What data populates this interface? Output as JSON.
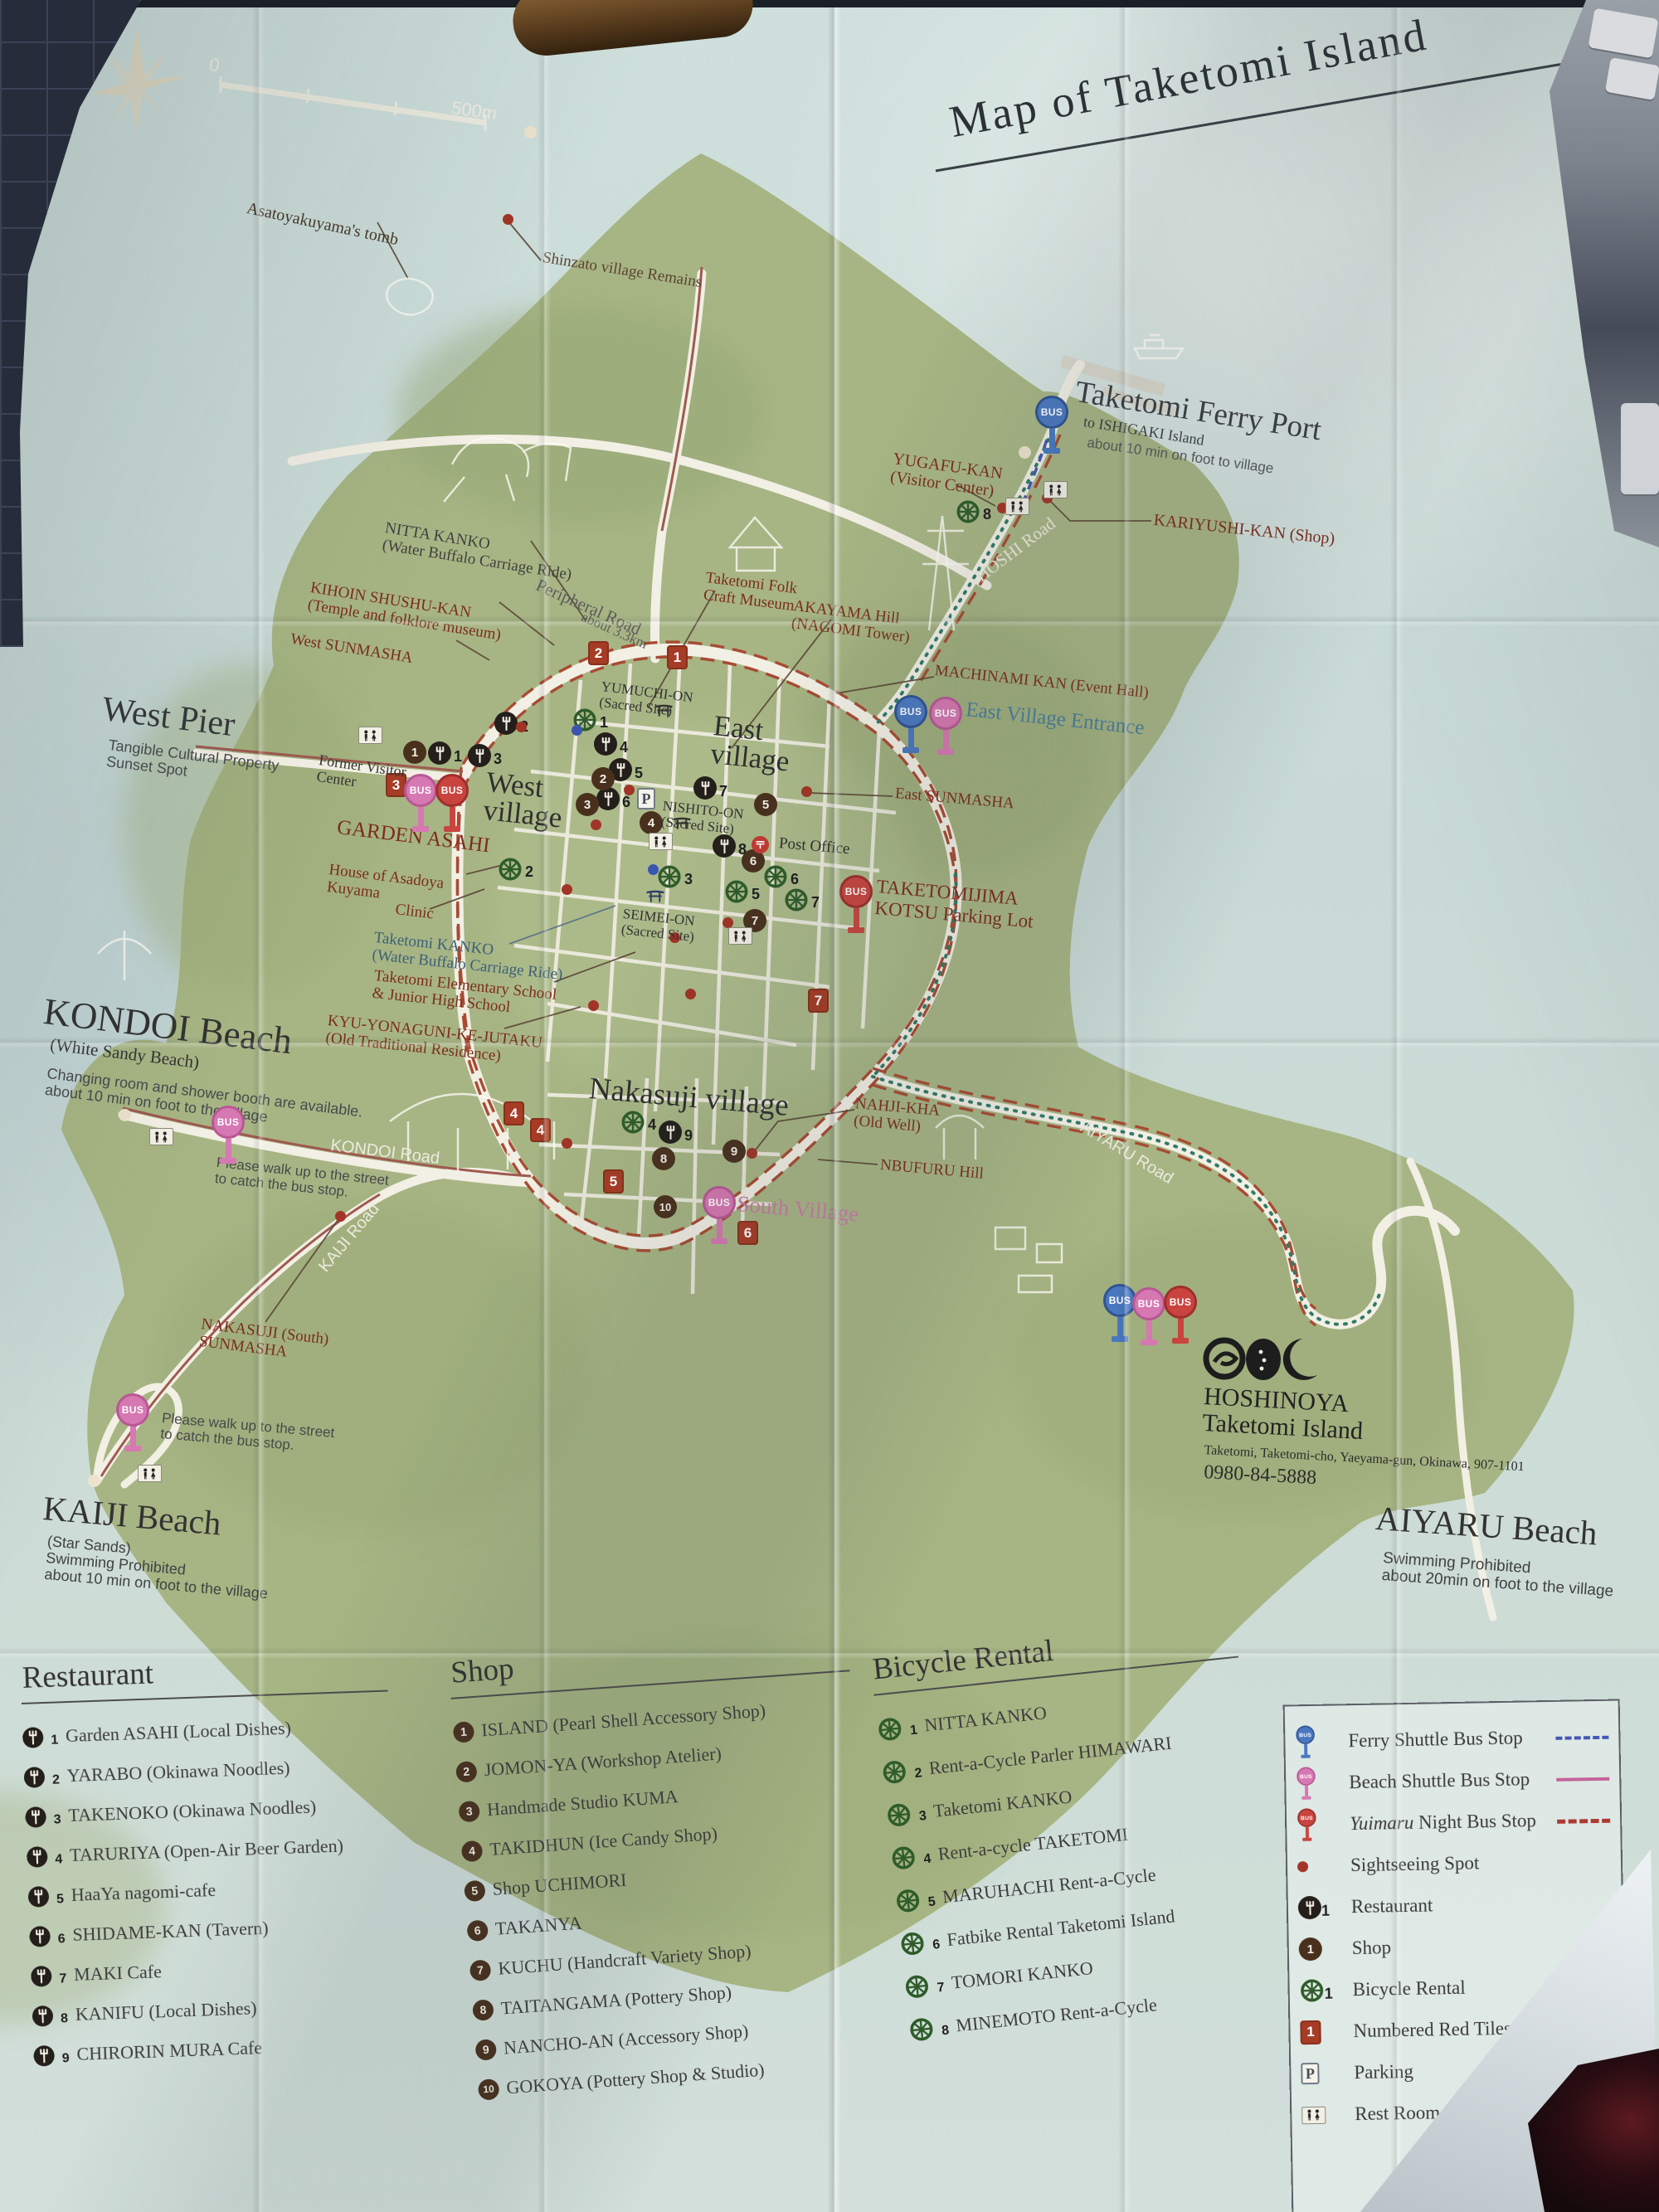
{
  "t": "Map of Taketomi Island",
  "scale": {
    "s0": "0",
    "s1": "500m"
  },
  "bus": "BUS",
  "nums": {
    "r": [
      "1",
      "2",
      "3",
      "4",
      "5",
      "6",
      "7",
      "8",
      "9"
    ],
    "s": [
      "1",
      "2",
      "3",
      "4",
      "5",
      "6",
      "7",
      "8",
      "9",
      "10"
    ],
    "b": [
      "1",
      "2",
      "3",
      "4",
      "5",
      "6",
      "7",
      "8"
    ],
    "t": [
      "1",
      "2",
      "3",
      "4",
      "4",
      "5",
      "6",
      "7"
    ]
  },
  "lab": {
    "asato": "Asatoyakuyama's tomb",
    "shinzato": "Shinzato village Remains",
    "ferry_t": "Taketomi Ferry Port",
    "ferry_s": "to ISHIGAKI Island",
    "ferry_n": "about 10 min on foot to village",
    "yugafu": "YUGAFU-KAN\n(Visitor Center)",
    "kariyushi": "KARIYUSHI-KAN (Shop)",
    "hoshi_rd": "HOSHI Road",
    "nitta": "NITTA KANKO\n(Water Buffalo Carriage Ride)",
    "kihoin": "KIHOIN SHUSHU-KAN\n(Temple and folklore museum)",
    "w_sun": "West SUNMASHA",
    "per_rd": "Peripheral Road",
    "per_sub": "about 3.3km",
    "yumuchi": "YUMUCHI-ON\n(Sacred Site)",
    "folk": "Taketomi Folk\nCraft Museum",
    "akayama": "AKAYAMA Hill\n(NAGOMI Tower)",
    "machinami": "MACHINAMI KAN  (Event Hall)",
    "e_ent": "East Village Entrance",
    "e_vil": "East\nvillage",
    "w_vil": "West\nvillage",
    "w_pier": "West Pier",
    "w_pier_s": "Tangible Cultural Property\nSunset Spot",
    "former": "Former Visitor\nCenter",
    "garden": "GARDEN ASAHI",
    "house": "House of Asadoya\nKuyama",
    "clinic": "Clinic",
    "nishito": "NISHITO-ON\n(Sacred Site)",
    "e_sun": "East SUNMASHA",
    "post": "Post Office",
    "seimei": "SEIMEI-ON\n(Sacred Site)",
    "tkanko": "Taketomi KANKO\n(Water Buffalo Carriage Ride)",
    "school": "Taketomi Elementary School\n& Junior High School",
    "kyu": "KYU-YONAGUNI-KE-JUTAKU\n(Old Traditional Residence)",
    "parking_lot": "TAKETOMIJIMA\nKOTSU Parking Lot",
    "kondoi": "KONDOI Beach",
    "kondoi_s": "(White Sandy Beach)",
    "kondoi_n": "Changing room and shower booth are available.\nabout 10 min on foot to the village",
    "kondoi_rd": "KONDOI Road",
    "busnote": "Please walk up to the street\nto catch the bus stop.",
    "nakasuji": "Nakasuji village",
    "nahji": "NAHJI-KHA\n(Old Well)",
    "nbufuru": "NBUFURU Hill",
    "s_vil": "South Village",
    "kaiji_rd": "KAIJI Road",
    "n_sun": "NAKASUJI (South)\nSUNMASHA",
    "kaiji": "KAIJI Beach",
    "kaiji_s": "(Star Sands)\nSwimming Prohibited\nabout 10 min on foot to the village",
    "aiyaru_rd": "AIYARU Road",
    "hoshinoya_t": "HOSHINOYA\nTaketomi Island",
    "hoshinoya_a": "Taketomi, Taketomi-cho, Yaeyama-gun, Okinawa, 907-1101",
    "hoshinoya_tel": "0980-84-5888",
    "aiyaru": "AIYARU Beach",
    "aiyaru_s": "Swimming Prohibited\nabout 20min on foot to the village"
  },
  "leg": {
    "rest": {
      "h": "Restaurant",
      "items": [
        {
          "n": "1",
          "t": "Garden ASAHI (Local Dishes)"
        },
        {
          "n": "2",
          "t": "YARABO  (Okinawa Noodles)"
        },
        {
          "n": "3",
          "t": "TAKENOKO (Okinawa Noodles)"
        },
        {
          "n": "4",
          "t": "TARURIYA (Open-Air Beer Garden)"
        },
        {
          "n": "5",
          "t": "HaaYa nagomi-cafe"
        },
        {
          "n": "6",
          "t": "SHIDAME-KAN  (Tavern)"
        },
        {
          "n": "7",
          "t": "MAKI Cafe"
        },
        {
          "n": "8",
          "t": "KANIFU  (Local Dishes)"
        },
        {
          "n": "9",
          "t": "CHIRORIN MURA Cafe"
        }
      ]
    },
    "shop": {
      "h": "Shop",
      "items": [
        {
          "n": "1",
          "t": "ISLAND (Pearl Shell Accessory Shop)"
        },
        {
          "n": "2",
          "t": "JOMON-YA  (Workshop Atelier)"
        },
        {
          "n": "3",
          "t": "Handmade Studio KUMA"
        },
        {
          "n": "4",
          "t": "TAKIDHUN  (Ice Candy Shop)"
        },
        {
          "n": "5",
          "t": "Shop UCHIMORI"
        },
        {
          "n": "6",
          "t": "TAKANYA"
        },
        {
          "n": "7",
          "t": "KUCHU (Handcraft Variety Shop)"
        },
        {
          "n": "8",
          "t": "TAITANGAMA (Pottery Shop)"
        },
        {
          "n": "9",
          "t": "NANCHO-AN (Accessory Shop)"
        },
        {
          "n": "10",
          "t": "GOKOYA (Pottery Shop & Studio)"
        }
      ]
    },
    "bike": {
      "h": "Bicycle Rental",
      "items": [
        {
          "n": "1",
          "t": "NITTA KANKO"
        },
        {
          "n": "2",
          "t": "Rent-a-Cycle Parler HIMAWARI"
        },
        {
          "n": "3",
          "t": "Taketomi KANKO"
        },
        {
          "n": "4",
          "t": "Rent-a-cycle TAKETOMI"
        },
        {
          "n": "5",
          "t": "MARUHACHI Rent-a-Cycle"
        },
        {
          "n": "6",
          "t": "Fatbike Rental Taketomi Island"
        },
        {
          "n": "7",
          "t": "TOMORI KANKO"
        },
        {
          "n": "8",
          "t": "MINEMOTO Rent-a-Cycle"
        }
      ]
    },
    "sym": {
      "ferry": "Ferry Shuttle Bus Stop",
      "beach": "Beach Shuttle Bus Stop",
      "yui_em": "Yuimaru",
      "yui_rest": " Night Bus Stop",
      "sight": "Sightseeing Spot",
      "rest": "Restaurant",
      "shop": "Shop",
      "bike": "Bicycle Rental",
      "tiles": "Numbered Red Tiles for",
      "parking": "Parking",
      "p": "P",
      "wc": "Rest Room"
    }
  }
}
